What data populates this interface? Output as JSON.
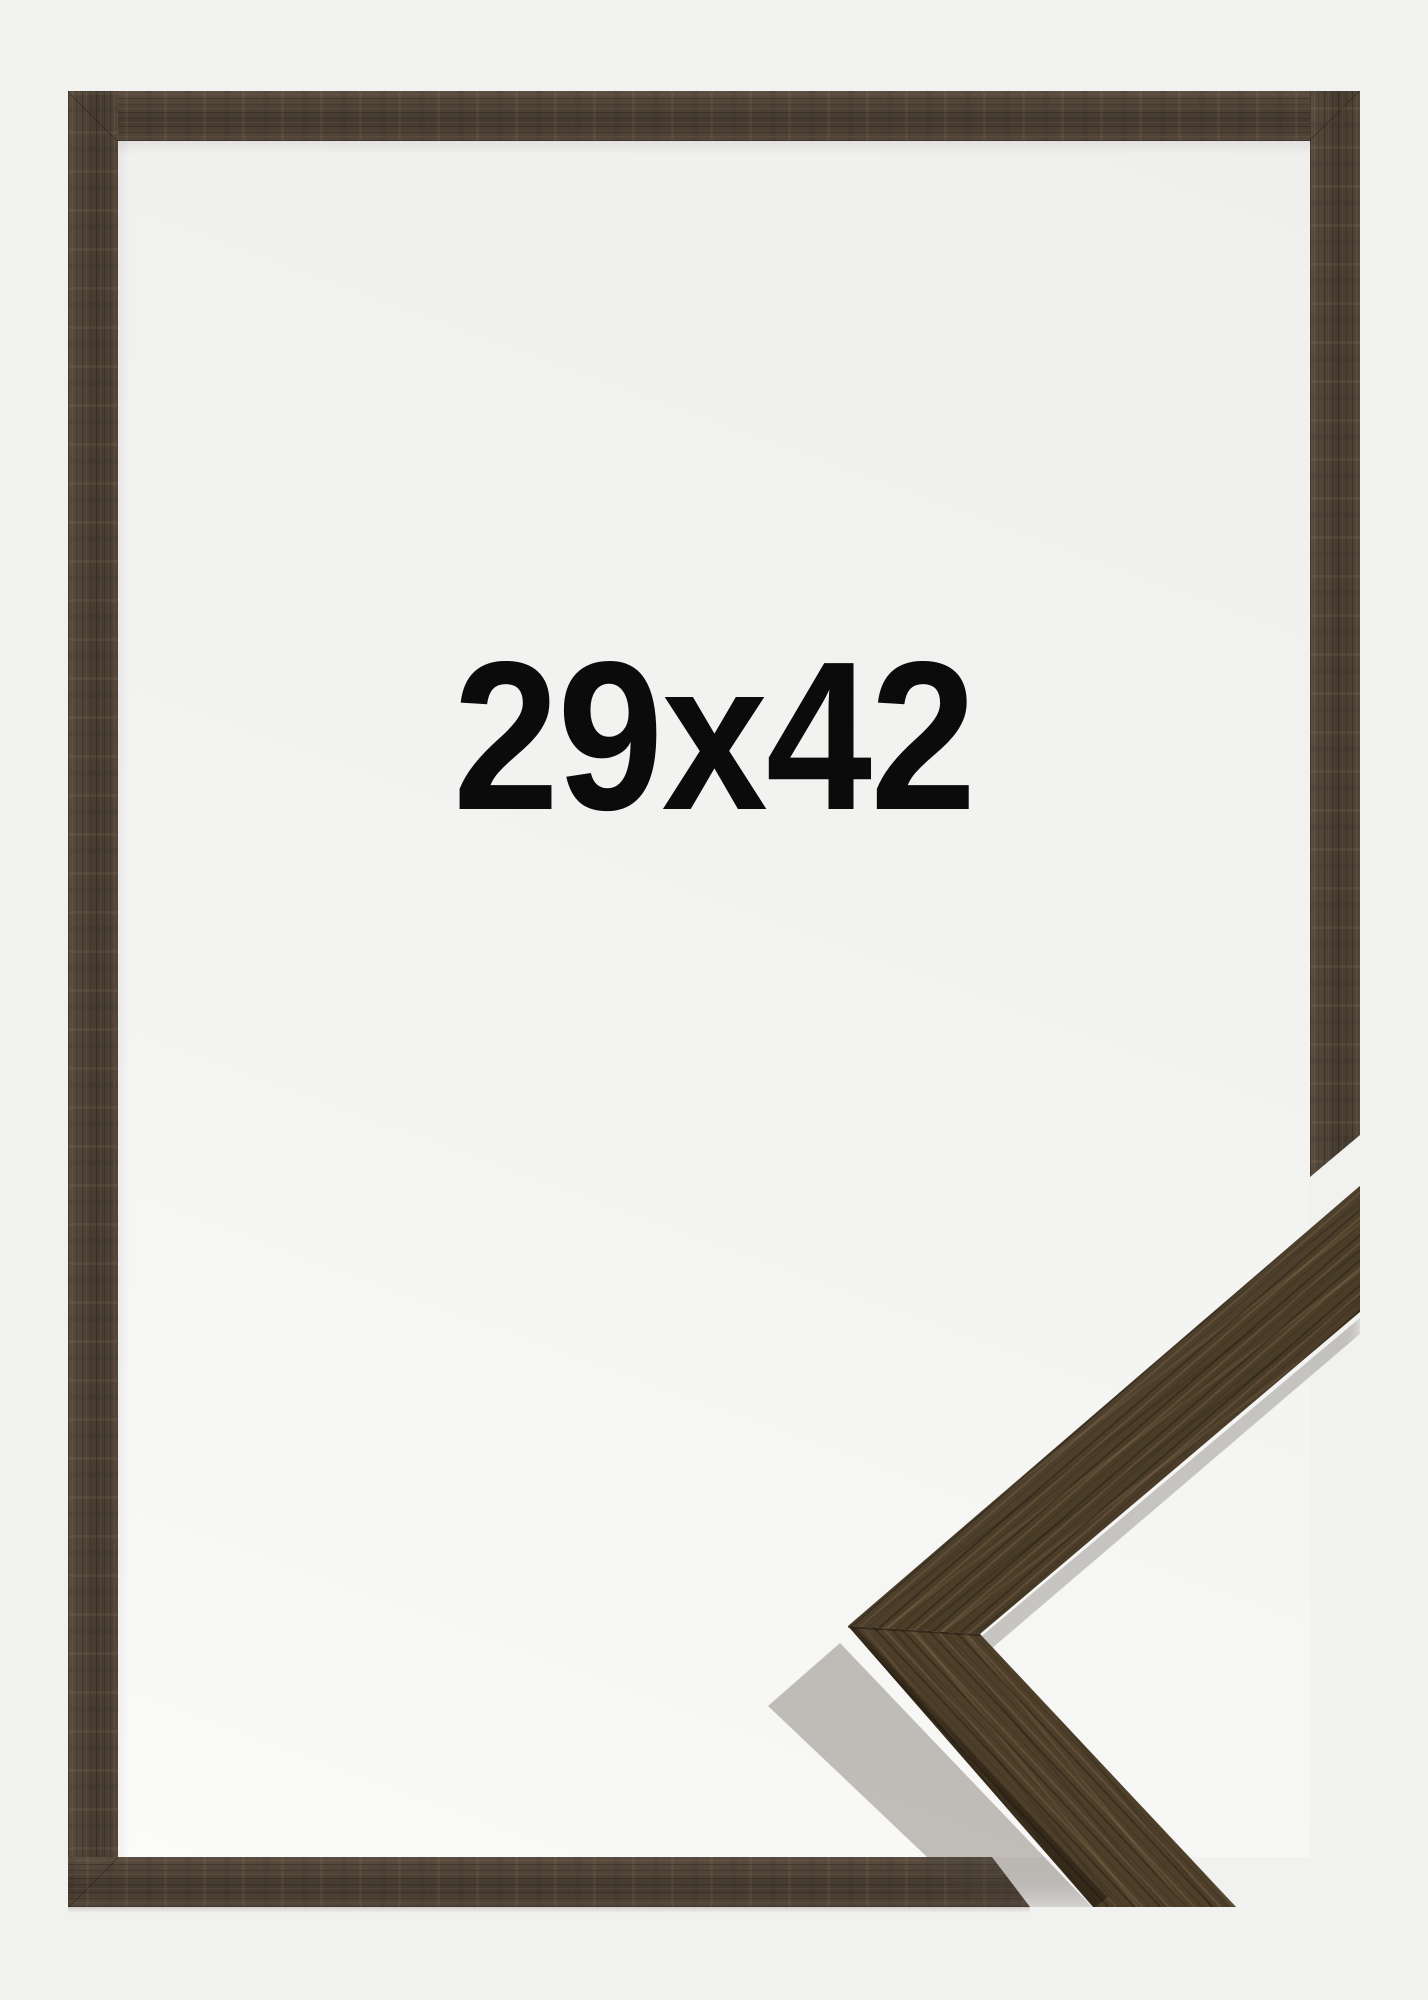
{
  "product_image": {
    "size_label": "29x42",
    "colors": {
      "page_background": "#f1f1ef",
      "inner_background": "#f2f2f0",
      "frame_wood_base": "#4c4034",
      "frame_wood_dark": "#2e241b",
      "frame_wood_light": "#6b5944",
      "sample_wood_base": "#57472f",
      "label_text": "#0b0b0b"
    }
  }
}
